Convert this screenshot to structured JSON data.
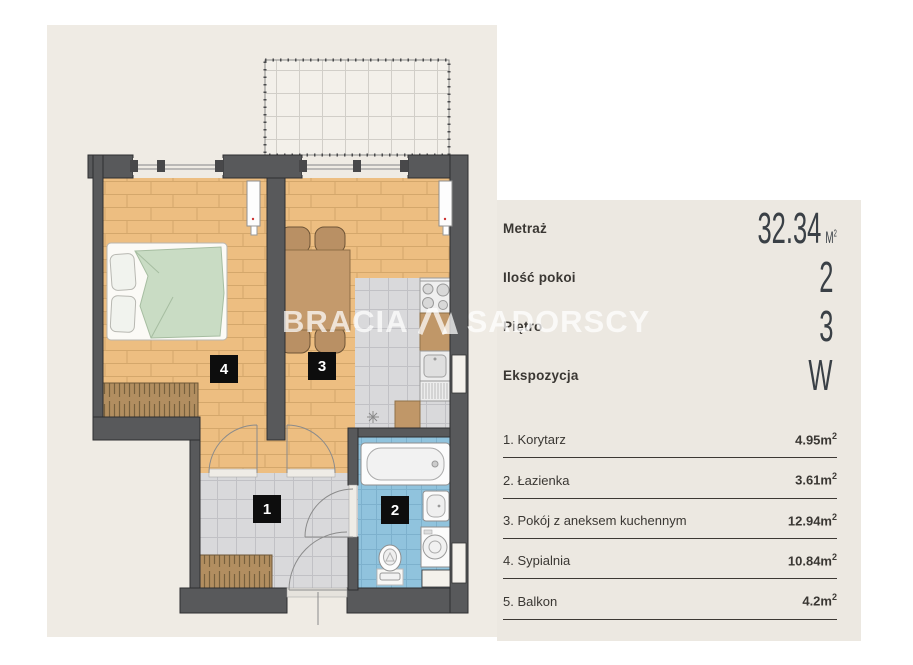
{
  "watermark": {
    "left": "BRACIA",
    "right": "SADORSCY",
    "logo": "roof-peak-logo"
  },
  "panel": {
    "specs": [
      {
        "label": "Metraż",
        "value": "32.34",
        "unit": "M",
        "unit_sup": "2"
      },
      {
        "label": "Ilość pokoi",
        "value": "2",
        "unit": "",
        "unit_sup": ""
      },
      {
        "label": "Piętro",
        "value": "3",
        "unit": "",
        "unit_sup": ""
      },
      {
        "label": "Ekspozycja",
        "value": "W",
        "unit": "",
        "unit_sup": ""
      }
    ],
    "rooms": [
      {
        "label": "1. Korytarz",
        "area": "4.95m",
        "sup": "2"
      },
      {
        "label": "2. Łazienka",
        "area": "3.61m",
        "sup": "2"
      },
      {
        "label": "3. Pokój z aneksem kuchennym",
        "area": "12.94m",
        "sup": "2"
      },
      {
        "label": "4. Sypialnia",
        "area": "10.84m",
        "sup": "2"
      },
      {
        "label": "5. Balkon",
        "area": "4.2m",
        "sup": "2"
      }
    ]
  },
  "floorplan": {
    "room_numbers": {
      "hall": "1",
      "bath": "2",
      "living": "3",
      "bedroom": "4"
    },
    "colors": {
      "background_beige": "#EFEBE4",
      "panel_beige": "#ECE8E1",
      "wall_gray": "#58595B",
      "wood_floor": "#EDBE81",
      "gray_tile": "#D9D9DB",
      "blue_tile": "#90C3DD",
      "furniture_brown": "#C09768",
      "bed_green": "#C9DCC4",
      "label_black": "#0D0D0D"
    }
  }
}
